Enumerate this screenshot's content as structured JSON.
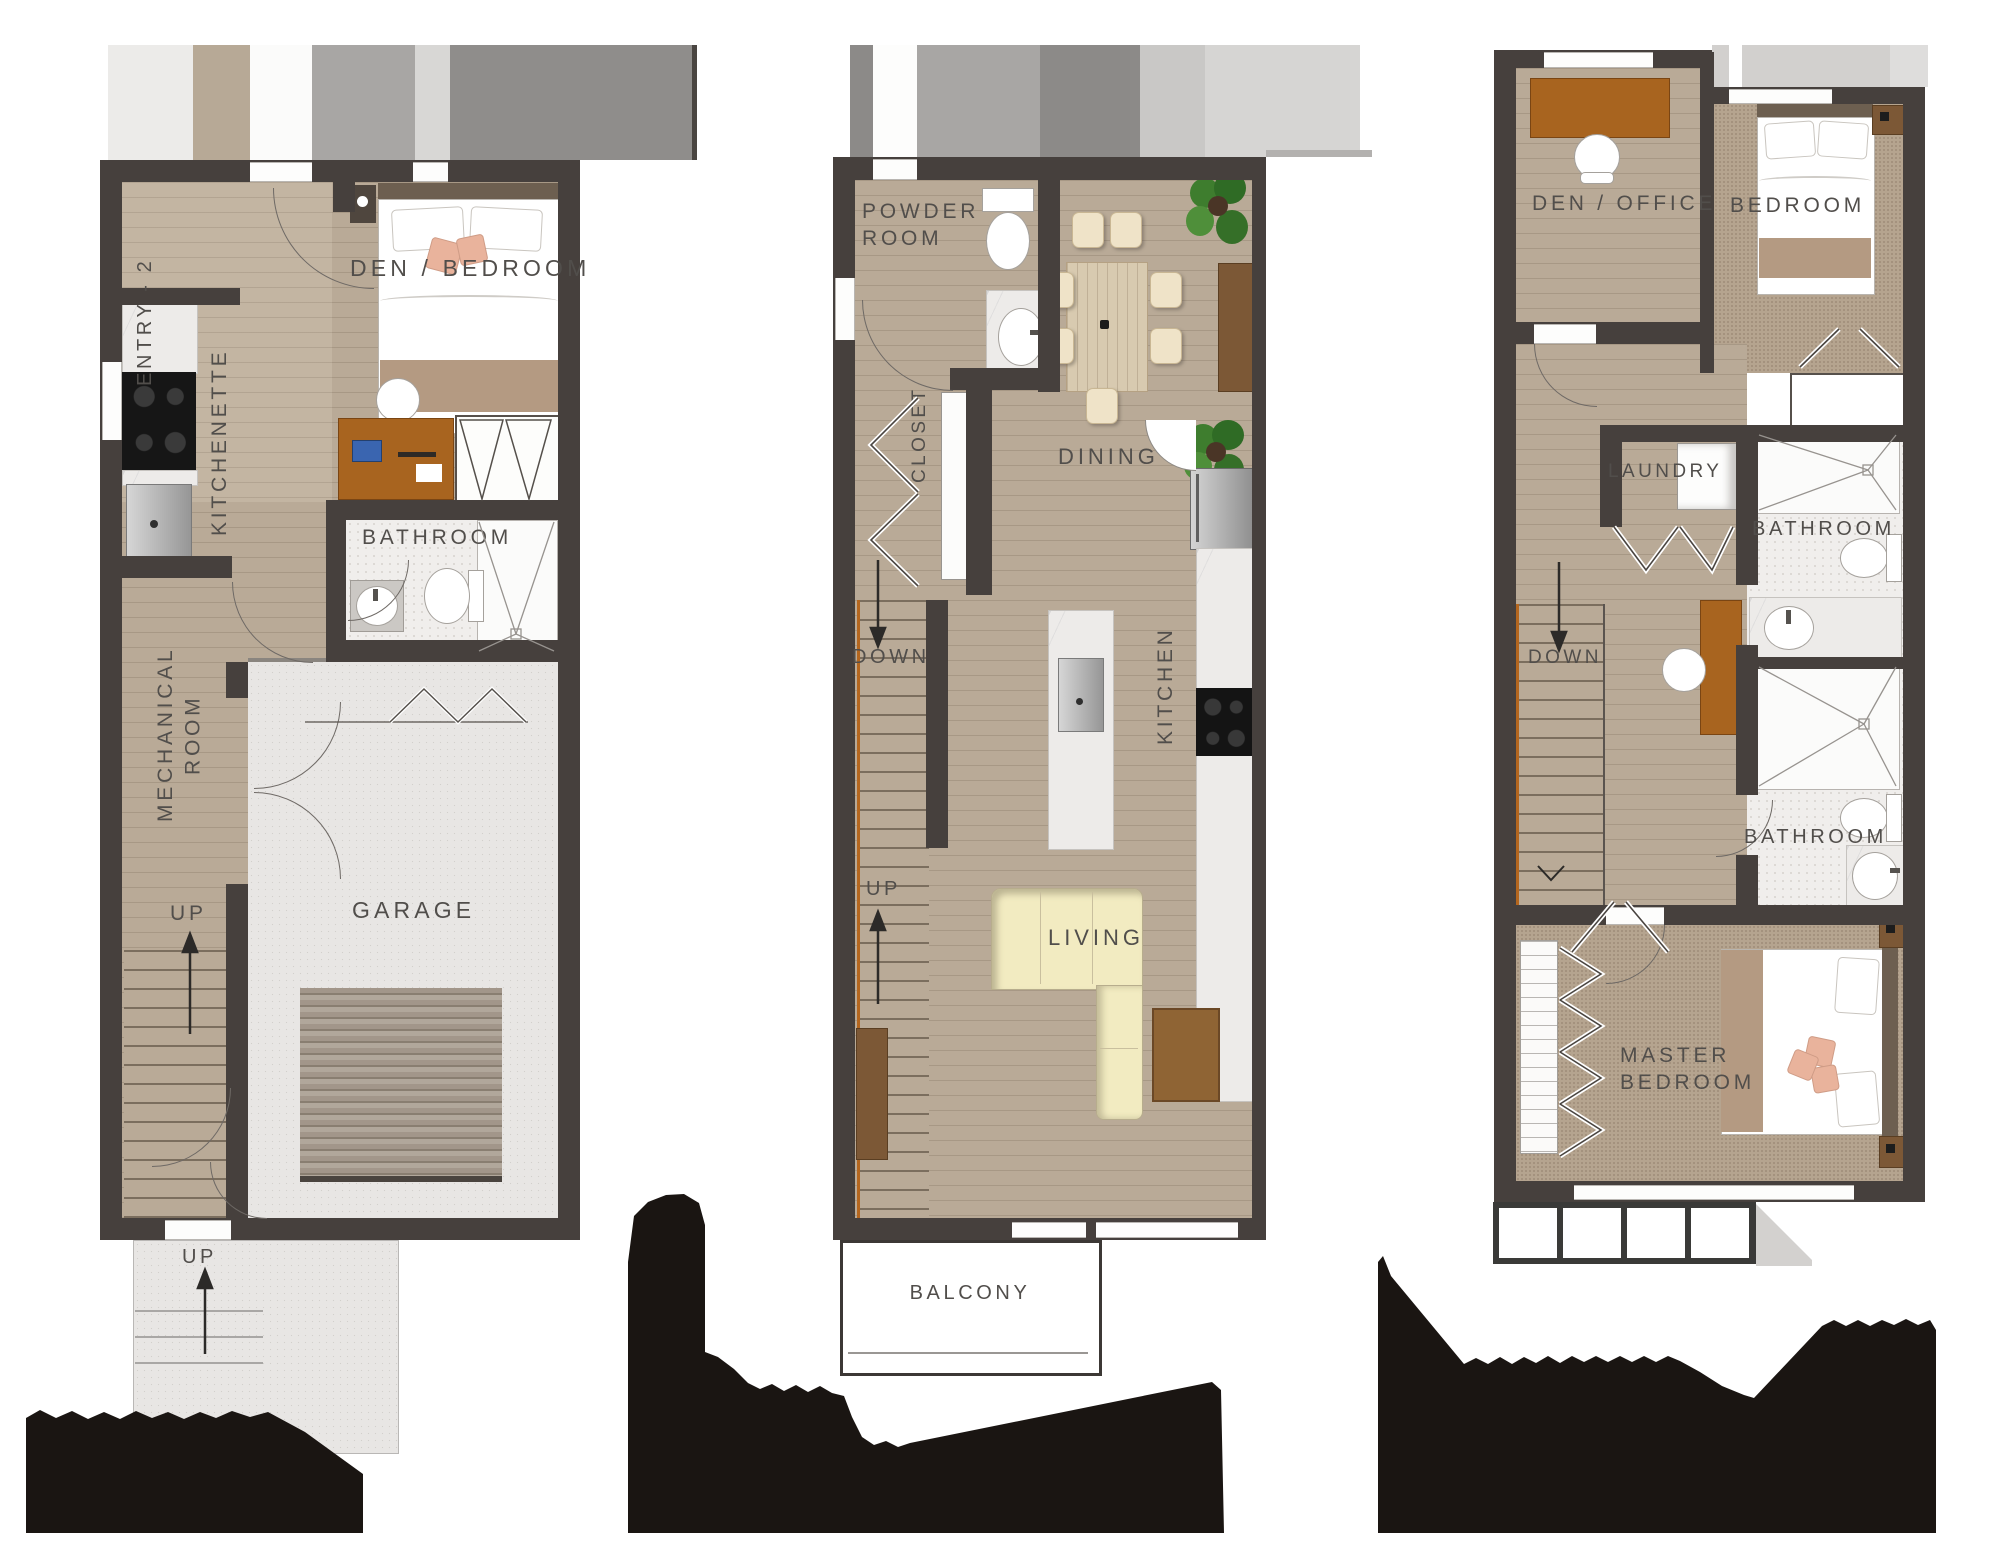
{
  "document": {
    "type": "floor-plan-sheet",
    "levels_shown": 3,
    "footer_note": "level titles are covered by black redaction shapes"
  },
  "colors": {
    "wall": "#46403d",
    "wood_floor": "#b9aa97",
    "carpet": "#b5a48f",
    "concrete": "#e8e6e4",
    "desk_wood": "#a8641f",
    "sofa": "#f2ebc1",
    "blanket": "#b49a82",
    "accent_pillow": "#e9b39c",
    "plant_green": "#3e7d2e",
    "label_text": "#514e4b",
    "redaction": "#1a1512"
  },
  "plans": {
    "basement": {
      "labels": {
        "entry": "ENTRY - 2",
        "den": "DEN / BEDROOM",
        "kitchenette": "KITCHENETTE",
        "bathroom": "BATHROOM",
        "mech1": "MECHANICAL",
        "mech2": "ROOM",
        "garage": "GARAGE",
        "up_inner": "UP",
        "up_outer": "UP"
      }
    },
    "main": {
      "labels": {
        "powder1": "POWDER",
        "powder2": "ROOM",
        "closet": "CLOSET",
        "dining": "DINING",
        "kitchen": "KITCHEN",
        "down": "DOWN",
        "up": "UP",
        "living": "LIVING",
        "balcony": "BALCONY"
      }
    },
    "upper": {
      "labels": {
        "den_office": "DEN / OFFICE",
        "bedroom": "BEDROOM",
        "laundry": "LAUNDRY",
        "bath_top": "BATHROOM",
        "down": "DOWN",
        "bath_mid": "BATHROOM",
        "master1": "MASTER",
        "master2": "BEDROOM"
      }
    }
  }
}
